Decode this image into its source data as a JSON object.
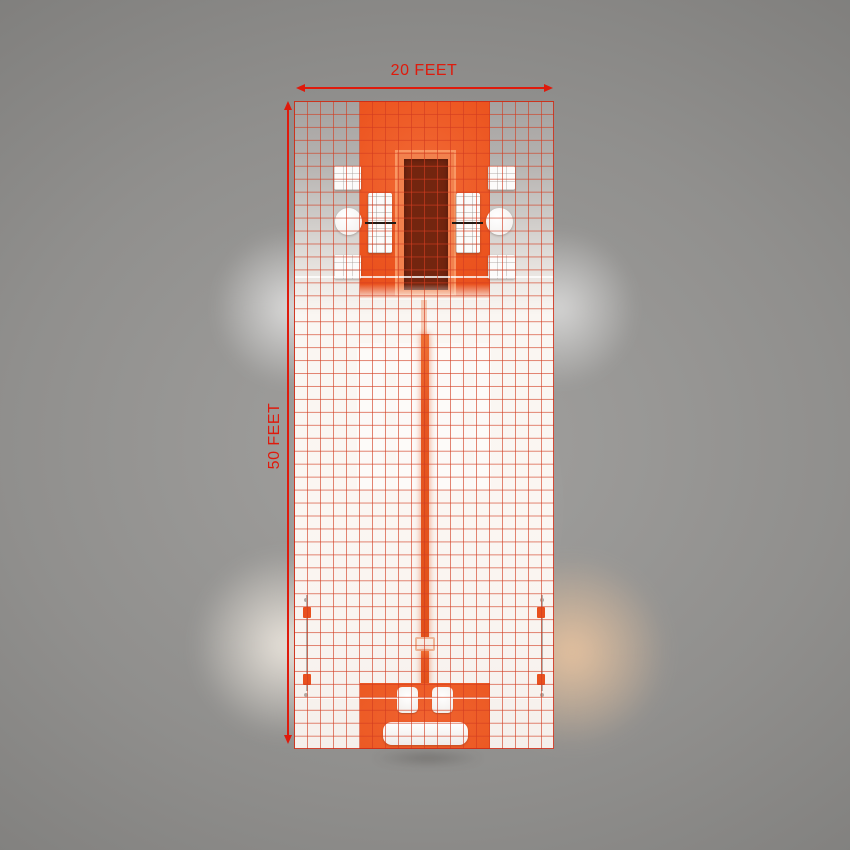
{
  "labels": {
    "width_dimension": "20 FEET",
    "height_dimension": "50 FEET"
  },
  "grid": {
    "columns": 20,
    "rows": 50,
    "feet_per_cell": 1
  },
  "colors": {
    "dimension-red": "#df1a0c",
    "grid-line": "#d23c20",
    "zone-orange": "#ec5520",
    "zone-orange-bottom": "#ec5a24",
    "stage-dark": "#73250f",
    "platform-orange": "#f2814d",
    "floor-white": "#faf6f2",
    "floor-gray-top": "#a5a2a0",
    "furniture-white": "#fcfbfa",
    "warm-glow": "#eac49f"
  },
  "objects": {
    "top_zone": "orange presentation area with dark stage platform",
    "side_furniture": [
      "display-table",
      "round-table",
      "shelf-panel"
    ],
    "center": "aisle runner strip",
    "bottom_zone": "orange reception area with two chairs and sofa"
  }
}
